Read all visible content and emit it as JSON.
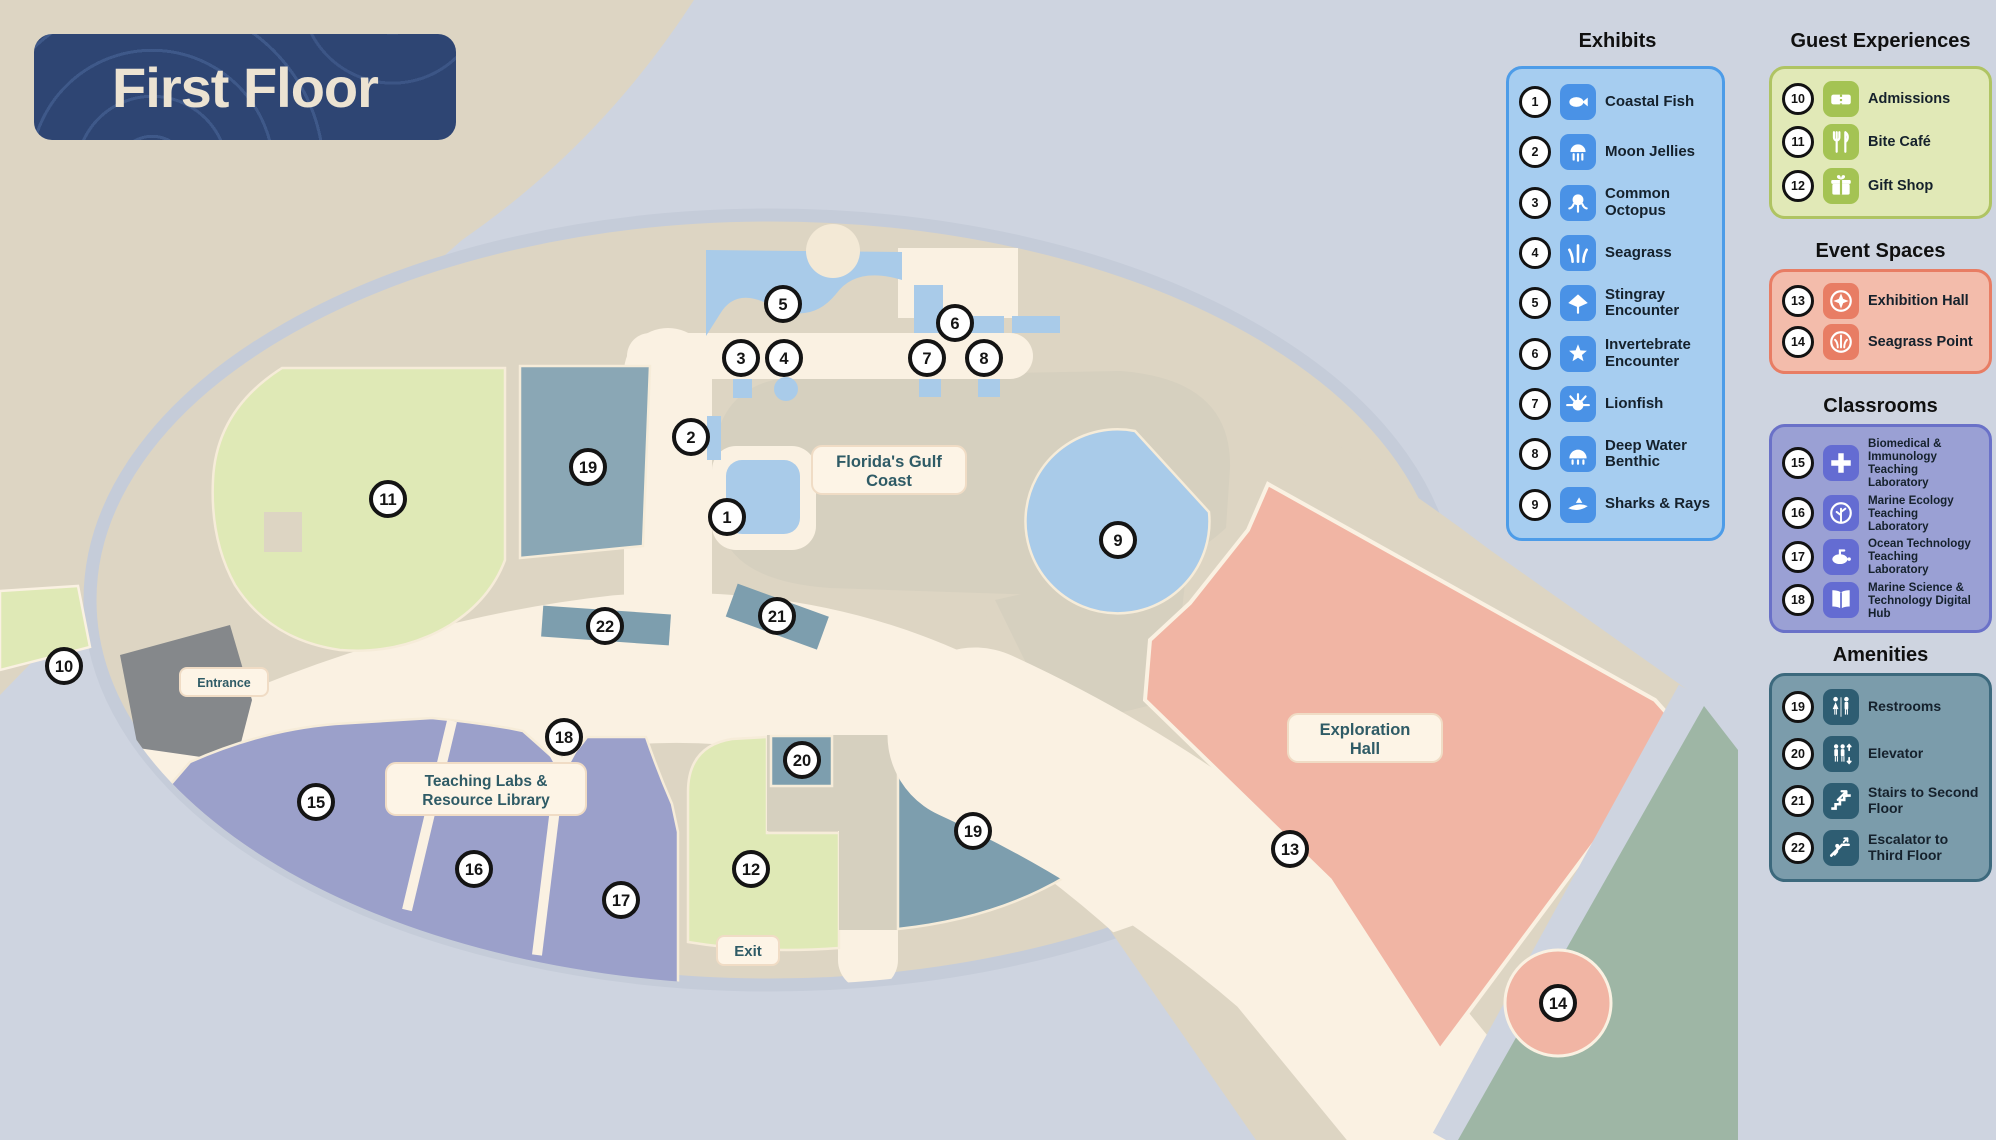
{
  "title": "First Floor",
  "map": {
    "labels": {
      "entrance": "Entrance",
      "exit": "Exit",
      "florida_gulf_coast": [
        "Florida's Gulf",
        "Coast"
      ],
      "exploration_hall": [
        "Exploration",
        "Hall"
      ],
      "teaching_labs": [
        "Teaching Labs &",
        "Resource Library"
      ]
    },
    "markers": [
      {
        "n": "1",
        "x": 727,
        "y": 517
      },
      {
        "n": "2",
        "x": 691,
        "y": 437
      },
      {
        "n": "3",
        "x": 741,
        "y": 358
      },
      {
        "n": "4",
        "x": 784,
        "y": 358
      },
      {
        "n": "5",
        "x": 783,
        "y": 304
      },
      {
        "n": "6",
        "x": 955,
        "y": 323
      },
      {
        "n": "7",
        "x": 927,
        "y": 358
      },
      {
        "n": "8",
        "x": 984,
        "y": 358
      },
      {
        "n": "9",
        "x": 1118,
        "y": 540
      },
      {
        "n": "10",
        "x": 64,
        "y": 666
      },
      {
        "n": "11",
        "x": 388,
        "y": 499
      },
      {
        "n": "12",
        "x": 751,
        "y": 869
      },
      {
        "n": "13",
        "x": 1290,
        "y": 849
      },
      {
        "n": "14",
        "x": 1558,
        "y": 1003
      },
      {
        "n": "15",
        "x": 316,
        "y": 802
      },
      {
        "n": "16",
        "x": 474,
        "y": 869
      },
      {
        "n": "17",
        "x": 621,
        "y": 900
      },
      {
        "n": "18",
        "x": 564,
        "y": 737
      },
      {
        "n": "19",
        "x": 588,
        "y": 467
      },
      {
        "n": "19",
        "x": 973,
        "y": 831
      },
      {
        "n": "20",
        "x": 802,
        "y": 760
      },
      {
        "n": "21",
        "x": 777,
        "y": 616
      },
      {
        "n": "22",
        "x": 605,
        "y": 626
      }
    ]
  },
  "legend": {
    "sections": [
      {
        "id": "exhibits",
        "title": "Exhibits",
        "icon_bg": "#4a92e6",
        "items": [
          {
            "num": "1",
            "label": "Coastal Fish",
            "icon": "fish-icon"
          },
          {
            "num": "2",
            "label": "Moon Jellies",
            "icon": "jellyfish-icon"
          },
          {
            "num": "3",
            "label": "Common Octopus",
            "icon": "octopus-icon"
          },
          {
            "num": "4",
            "label": "Seagrass",
            "icon": "seagrass-icon"
          },
          {
            "num": "5",
            "label": "Stingray Encounter",
            "icon": "stingray-icon"
          },
          {
            "num": "6",
            "label": "Invertebrate Encounter",
            "icon": "starfish-icon"
          },
          {
            "num": "7",
            "label": "Lionfish",
            "icon": "lionfish-icon"
          },
          {
            "num": "8",
            "label": "Deep Water Benthic",
            "icon": "benthic-icon"
          },
          {
            "num": "9",
            "label": "Sharks & Rays",
            "icon": "shark-icon"
          }
        ]
      },
      {
        "id": "guest",
        "title": "Guest Experiences",
        "icon_bg": "#a4c353",
        "items": [
          {
            "num": "10",
            "label": "Admissions",
            "icon": "ticket-icon"
          },
          {
            "num": "11",
            "label": "Bite Café",
            "icon": "cafe-icon"
          },
          {
            "num": "12",
            "label": "Gift Shop",
            "icon": "gift-icon"
          }
        ]
      },
      {
        "id": "event",
        "title": "Event Spaces",
        "icon_bg": "#e87d64",
        "items": [
          {
            "num": "13",
            "label": "Exhibition Hall",
            "icon": "compass-icon"
          },
          {
            "num": "14",
            "label": "Seagrass Point",
            "icon": "seagrass-circle-icon"
          }
        ]
      },
      {
        "id": "classrooms",
        "title": "Classrooms",
        "icon_bg": "#646cd2",
        "items": [
          {
            "num": "15",
            "label": "Biomedical & Immunology Teaching Laboratory",
            "icon": "medical-icon"
          },
          {
            "num": "16",
            "label": "Marine Ecology Teaching Laboratory",
            "icon": "ecology-icon"
          },
          {
            "num": "17",
            "label": "Ocean Technology Teaching Laboratory",
            "icon": "ocean-tech-icon"
          },
          {
            "num": "18",
            "label": "Marine Science & Technology Digital Hub",
            "icon": "book-icon"
          }
        ]
      },
      {
        "id": "amenities",
        "title": "Amenities",
        "icon_bg": "#2e5d72",
        "items": [
          {
            "num": "19",
            "label": "Restrooms",
            "icon": "restroom-icon"
          },
          {
            "num": "20",
            "label": "Elevator",
            "icon": "elevator-icon"
          },
          {
            "num": "21",
            "label": "Stairs to Second Floor",
            "icon": "stairs-icon"
          },
          {
            "num": "22",
            "label": "Escalator to Third Floor",
            "icon": "escalator-icon"
          }
        ]
      }
    ]
  },
  "colors": {
    "background": "#ced4e0",
    "sand": "#ddd5c3",
    "sand_dark": "#d6d0bf",
    "walkway": "#faf1e2",
    "water": "#a9cbe9",
    "slate": "#7d9eae",
    "slate_light": "#8aa7b5",
    "purple": "#9ba0ca",
    "green": "#dfe9b6",
    "salmon": "#f1b5a4",
    "salmon_deep": "#e87d64",
    "sage": "#9eb6a5",
    "navy": "#2e4573",
    "ring": "#c5ccd9",
    "entrance_gray": "#85888b",
    "label_text": "#2f5b66",
    "marker_ink": "#141414"
  }
}
